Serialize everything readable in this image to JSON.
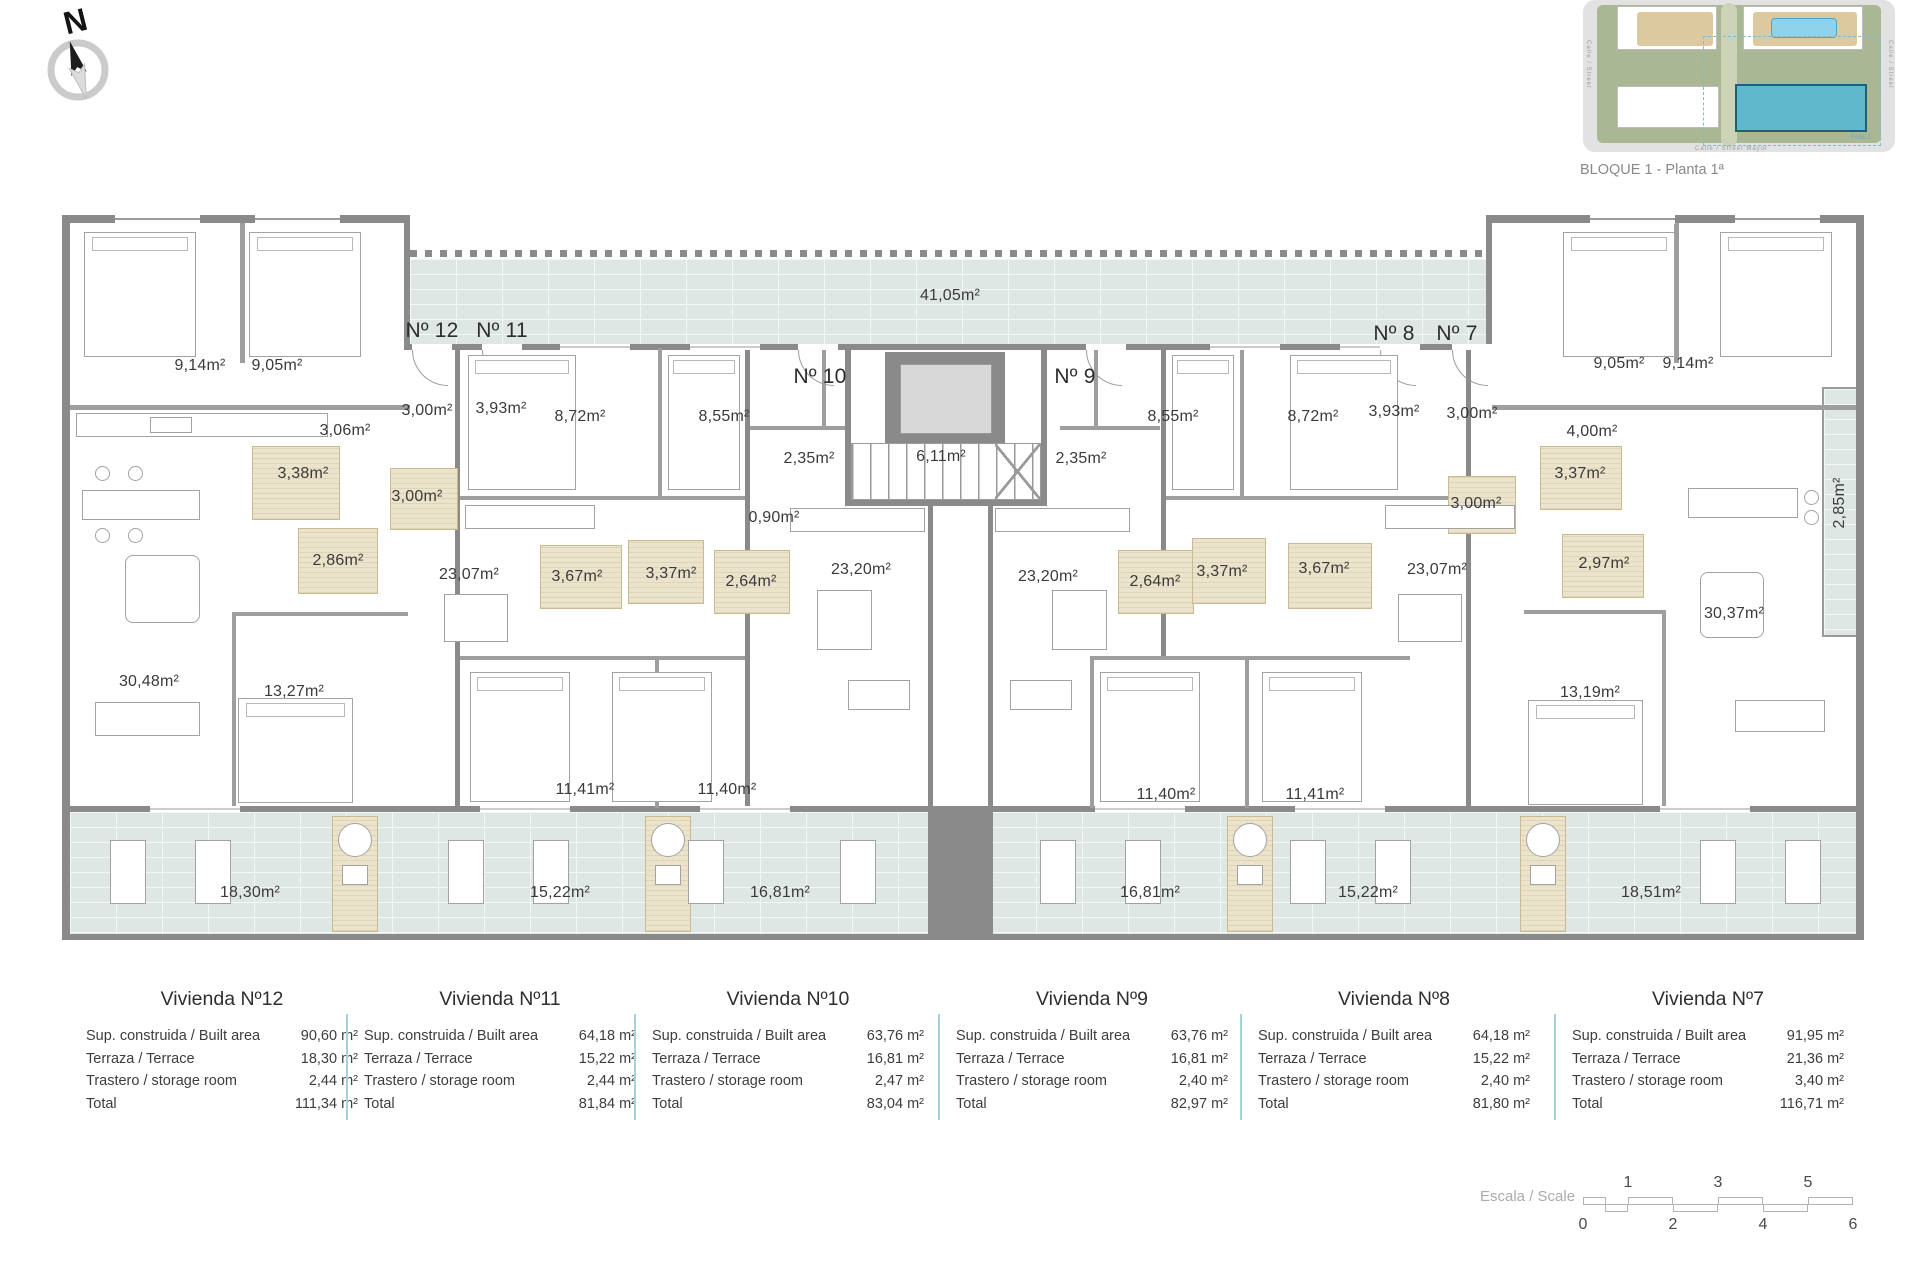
{
  "header": {
    "compass_letter": "N",
    "caption": "BLOQUE 1 - Planta 1ª"
  },
  "sitemap": {
    "street_bottom": "Calle / Street Mayor",
    "street_left": "Calle / Street",
    "street_right": "Calle / Street",
    "phase_label": "FASE 1"
  },
  "colors": {
    "wall": "#8a8a8a",
    "tile": "#dfe7e5",
    "bath": "#ece3cc",
    "table_divider": "#a5d3d6",
    "highlight_building": "#5fb8cc"
  },
  "plan": {
    "rooms": [
      {
        "x": 432,
        "y": 331,
        "t": "Nº 12",
        "c": "big"
      },
      {
        "x": 502,
        "y": 331,
        "t": "Nº 11",
        "c": "big"
      },
      {
        "x": 820,
        "y": 377,
        "t": "Nº 10",
        "c": "big"
      },
      {
        "x": 1075,
        "y": 377,
        "t": "Nº 9",
        "c": "big"
      },
      {
        "x": 1394,
        "y": 334,
        "t": "Nº 8",
        "c": "big"
      },
      {
        "x": 1457,
        "y": 334,
        "t": "Nº 7",
        "c": "big"
      },
      {
        "x": 950,
        "y": 296,
        "t": "41,05m²"
      },
      {
        "x": 200,
        "y": 366,
        "t": "9,14m²"
      },
      {
        "x": 277,
        "y": 366,
        "t": "9,05m²"
      },
      {
        "x": 1619,
        "y": 364,
        "t": "9,05m²"
      },
      {
        "x": 1688,
        "y": 364,
        "t": "9,14m²"
      },
      {
        "x": 345,
        "y": 431,
        "t": "3,06m²"
      },
      {
        "x": 1592,
        "y": 432,
        "t": "4,00m²"
      },
      {
        "x": 427,
        "y": 411,
        "t": "3,00m²"
      },
      {
        "x": 501,
        "y": 409,
        "t": "3,93m²"
      },
      {
        "x": 1394,
        "y": 412,
        "t": "3,93m²"
      },
      {
        "x": 1472,
        "y": 414,
        "t": "3,00m²"
      },
      {
        "x": 580,
        "y": 417,
        "t": "8,72m²"
      },
      {
        "x": 724,
        "y": 417,
        "t": "8,55m²"
      },
      {
        "x": 1173,
        "y": 417,
        "t": "8,55m²"
      },
      {
        "x": 1313,
        "y": 417,
        "t": "8,72m²"
      },
      {
        "x": 809,
        "y": 459,
        "t": "2,35m²"
      },
      {
        "x": 941,
        "y": 457,
        "t": "6,11m²"
      },
      {
        "x": 1081,
        "y": 459,
        "t": "2,35m²"
      },
      {
        "x": 774,
        "y": 518,
        "t": "0,90m²"
      },
      {
        "x": 303,
        "y": 474,
        "t": "3,38m²"
      },
      {
        "x": 417,
        "y": 497,
        "t": "3,00m²"
      },
      {
        "x": 338,
        "y": 561,
        "t": "2,86m²"
      },
      {
        "x": 577,
        "y": 577,
        "t": "3,67m²"
      },
      {
        "x": 671,
        "y": 574,
        "t": "3,37m²"
      },
      {
        "x": 751,
        "y": 582,
        "t": "2,64m²"
      },
      {
        "x": 1155,
        "y": 582,
        "t": "2,64m²"
      },
      {
        "x": 1222,
        "y": 572,
        "t": "3,37m²"
      },
      {
        "x": 1324,
        "y": 569,
        "t": "3,67m²"
      },
      {
        "x": 1476,
        "y": 504,
        "t": "3,00m²"
      },
      {
        "x": 1580,
        "y": 474,
        "t": "3,37m²"
      },
      {
        "x": 1604,
        "y": 564,
        "t": "2,97m²"
      },
      {
        "x": 861,
        "y": 570,
        "t": "23,20m²"
      },
      {
        "x": 1048,
        "y": 577,
        "t": "23,20m²"
      },
      {
        "x": 469,
        "y": 575,
        "t": "23,07m²"
      },
      {
        "x": 1437,
        "y": 570,
        "t": "23,07m²"
      },
      {
        "x": 149,
        "y": 682,
        "t": "30,48m²"
      },
      {
        "x": 294,
        "y": 692,
        "t": "13,27m²"
      },
      {
        "x": 1590,
        "y": 693,
        "t": "13,19m²"
      },
      {
        "x": 1734,
        "y": 614,
        "t": "30,37m²"
      },
      {
        "x": 585,
        "y": 790,
        "t": "11,41m²"
      },
      {
        "x": 727,
        "y": 790,
        "t": "11,40m²"
      },
      {
        "x": 1166,
        "y": 795,
        "t": "11,40m²"
      },
      {
        "x": 1315,
        "y": 795,
        "t": "11,41m²"
      },
      {
        "x": 1840,
        "y": 503,
        "t": "2,85m²",
        "r": -90
      },
      {
        "x": 250,
        "y": 893,
        "t": "18,30m²"
      },
      {
        "x": 560,
        "y": 893,
        "t": "15,22m²"
      },
      {
        "x": 780,
        "y": 893,
        "t": "16,81m²"
      },
      {
        "x": 1150,
        "y": 893,
        "t": "16,81m²"
      },
      {
        "x": 1368,
        "y": 893,
        "t": "15,22m²"
      },
      {
        "x": 1651,
        "y": 893,
        "t": "18,51m²"
      }
    ]
  },
  "tables": {
    "xs": [
      86,
      364,
      652,
      956,
      1258,
      1572
    ],
    "list": [
      {
        "title": "Vivienda Nº12",
        "rows": [
          [
            "Sup. construida / Built area",
            "90,60 m²"
          ],
          [
            "Terraza / Terrace",
            "18,30 m²"
          ],
          [
            "Trastero / storage room",
            "2,44 m²"
          ],
          [
            "Total",
            "111,34 m²"
          ]
        ]
      },
      {
        "title": "Vivienda Nº11",
        "rows": [
          [
            "Sup. construida / Built area",
            "64,18 m²"
          ],
          [
            "Terraza / Terrace",
            "15,22 m²"
          ],
          [
            "Trastero / storage room",
            "2,44 m²"
          ],
          [
            "Total",
            "81,84 m²"
          ]
        ]
      },
      {
        "title": "Vivienda Nº10",
        "rows": [
          [
            "Sup. construida / Built area",
            "63,76 m²"
          ],
          [
            "Terraza / Terrace",
            "16,81 m²"
          ],
          [
            "Trastero / storage room",
            "2,47 m²"
          ],
          [
            "Total",
            "83,04 m²"
          ]
        ]
      },
      {
        "title": "Vivienda Nº9",
        "rows": [
          [
            "Sup. construida / Built area",
            "63,76 m²"
          ],
          [
            "Terraza / Terrace",
            "16,81 m²"
          ],
          [
            "Trastero / storage room",
            "2,40 m²"
          ],
          [
            "Total",
            "82,97 m²"
          ]
        ]
      },
      {
        "title": "Vivienda Nº8",
        "rows": [
          [
            "Sup. construida / Built area",
            "64,18 m²"
          ],
          [
            "Terraza / Terrace",
            "15,22 m²"
          ],
          [
            "Trastero / storage room",
            "2,40 m²"
          ],
          [
            "Total",
            "81,80 m²"
          ]
        ]
      },
      {
        "title": "Vivienda Nº7",
        "rows": [
          [
            "Sup. construida / Built area",
            "91,95 m²"
          ],
          [
            "Terraza / Terrace",
            "21,36 m²"
          ],
          [
            "Trastero / storage room",
            "3,40 m²"
          ],
          [
            "Total",
            "116,71 m²"
          ]
        ]
      }
    ]
  },
  "scalebar": {
    "label": "Escala / Scale",
    "top": [
      "1",
      "3",
      "5"
    ],
    "bottom": [
      "0",
      "2",
      "4",
      "6"
    ]
  }
}
